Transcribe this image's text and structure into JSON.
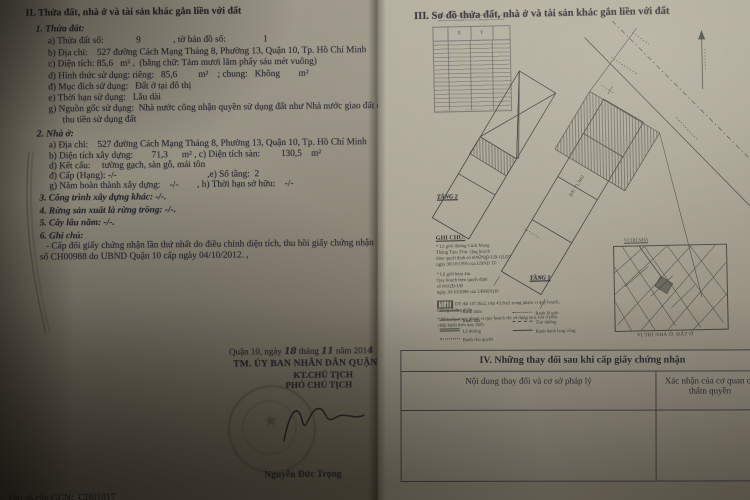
{
  "photo": {
    "background": "#2c271e",
    "ink": "#2e2f3b"
  },
  "left": {
    "title": "II. Thửa đất, nhà ở và tài sản khác gắn liền với đất",
    "parcel_heading": "1. Thửa đất:",
    "parcel_lines": [
      "a) Thửa đất số:              9              , tờ bản đồ số:                1",
      "b) Địa chỉ:    527 đường Cách Mạng Tháng 8, Phường 13, Quận 10, Tp. Hồ Chí Minh",
      "c) Diện tích: 85,6   m² ,  (bằng chữ: Tám mươi lăm phẩy sáu mét vuông)",
      "d) Hình thức sử dụng: riêng:   85,6         m²    ; chung:   Không        m²",
      "đ) Mục đích sử dụng:   Đất ở tại đô thị",
      "e) Thời hạn sử dụng:   Lâu dài",
      "g) Nguồn gốc sử dụng:  Nhà nước công nhận quyền sử dụng đất như Nhà nước giao đất có",
      "thu tiền sử dụng đất"
    ],
    "house_heading": "2. Nhà ở:",
    "house_lines": [
      "a) Địa chỉ:    527 đường Cách Mạng Tháng 8, Phường 13, Quận 10, Tp. Hồ Chí Minh",
      "b) Diện tích xây dựng:        71,3      m² , c) Diện tích sàn:         130,5    m²",
      "d) Kết cấu:     tường gạch, sàn gỗ, mái tôn",
      "đ) Cấp (Hạng): -/-                                       ,e) Số tầng:  2",
      "g) Năm hoàn thành xây dựng:    -/-        , h) Thời hạn sở hữu:    -/-"
    ],
    "item3": "3. Công trình xây dựng khác: -/-.",
    "item4": "4. Rừng sản xuất là rừng trồng: -/-.",
    "item5": "5. Cây lâu năm: -/-.",
    "notes_heading": "6. Ghi chú:",
    "notes_lines": [
      "- Cấp đổi giấy chứng nhận lần thứ nhất do điều chỉnh diện tích, thu hồi giấy chứng nhận",
      "số CH00988 do UBND Quận 10 cấp ngày 04/10/2012. ,"
    ],
    "sig": {
      "place": "Quận 10, ngày ",
      "day": "18",
      "thang": " tháng ",
      "month": "11",
      "nam": " năm 201",
      "year_digit": "4",
      "authority": "TM. ỦY BAN NHÂN DÂN QUẬN 10",
      "kt": "KT.CHỦ TỊCH",
      "deputy": "PHÓ CHỦ TỊCH",
      "signer": "Nguyễn Đức Trọng"
    },
    "footer": "vào sổ cấp GCN:  CH01017"
  },
  "right": {
    "title": "III. Sơ đồ thửa đất, nhà ở và tài sản khác gắn liền với đất",
    "coord": {
      "x": "X",
      "y": "Y"
    },
    "floor2": "TẦNG 2",
    "floor1": "TẦNG 1",
    "area": "DT: 71,3m2",
    "ghichu_heading": "GHI CHÚ:",
    "ghichu_lines": [
      "* Lộ giới đường Cách Mạng",
      "Tháng Tám 35m. Quy hoạch",
      "theo quyết định số 6982/QĐ-UB-QLĐT",
      "ngày 30/10/1995 của UBND TP",
      "* Lộ giới hẻm 4m.",
      "Quy hoạch theo quyết định",
      "số 06/QĐ-UB",
      "ngày 30/10/2008 của UBNDQ10"
    ],
    "hatch_note": "DT đất 107,8m2, nhà 43,9m2 trong phạm vi quy hoạch, không chứng nhận",
    "note2": "* Nhà xây trong phạm vi quy hoạch chỉ sử dụng tạm, khi ở phải chấp hành theo quy định.",
    "legend_left": [
      "Ranh thửa",
      "Ranh nhà",
      "Lề đường",
      "Ranh chủ quyền"
    ],
    "legend_right": [
      "Ranh lộ giới",
      "Tim đường",
      "Ranh hành lang cống"
    ],
    "map_pointer": "VỊ TRÍ NHÀ",
    "map_caption": "VỊ TRÍ NHÀ Ở, ĐẤT Ở",
    "s4_title": "IV. Những thay đổi sau khi cấp giấy chứng nhận",
    "s4_col1": "Nội dung thay đổi và cơ sở pháp lý",
    "s4_col2": "Xác nhận của cơ quan có thẩm quyền"
  }
}
